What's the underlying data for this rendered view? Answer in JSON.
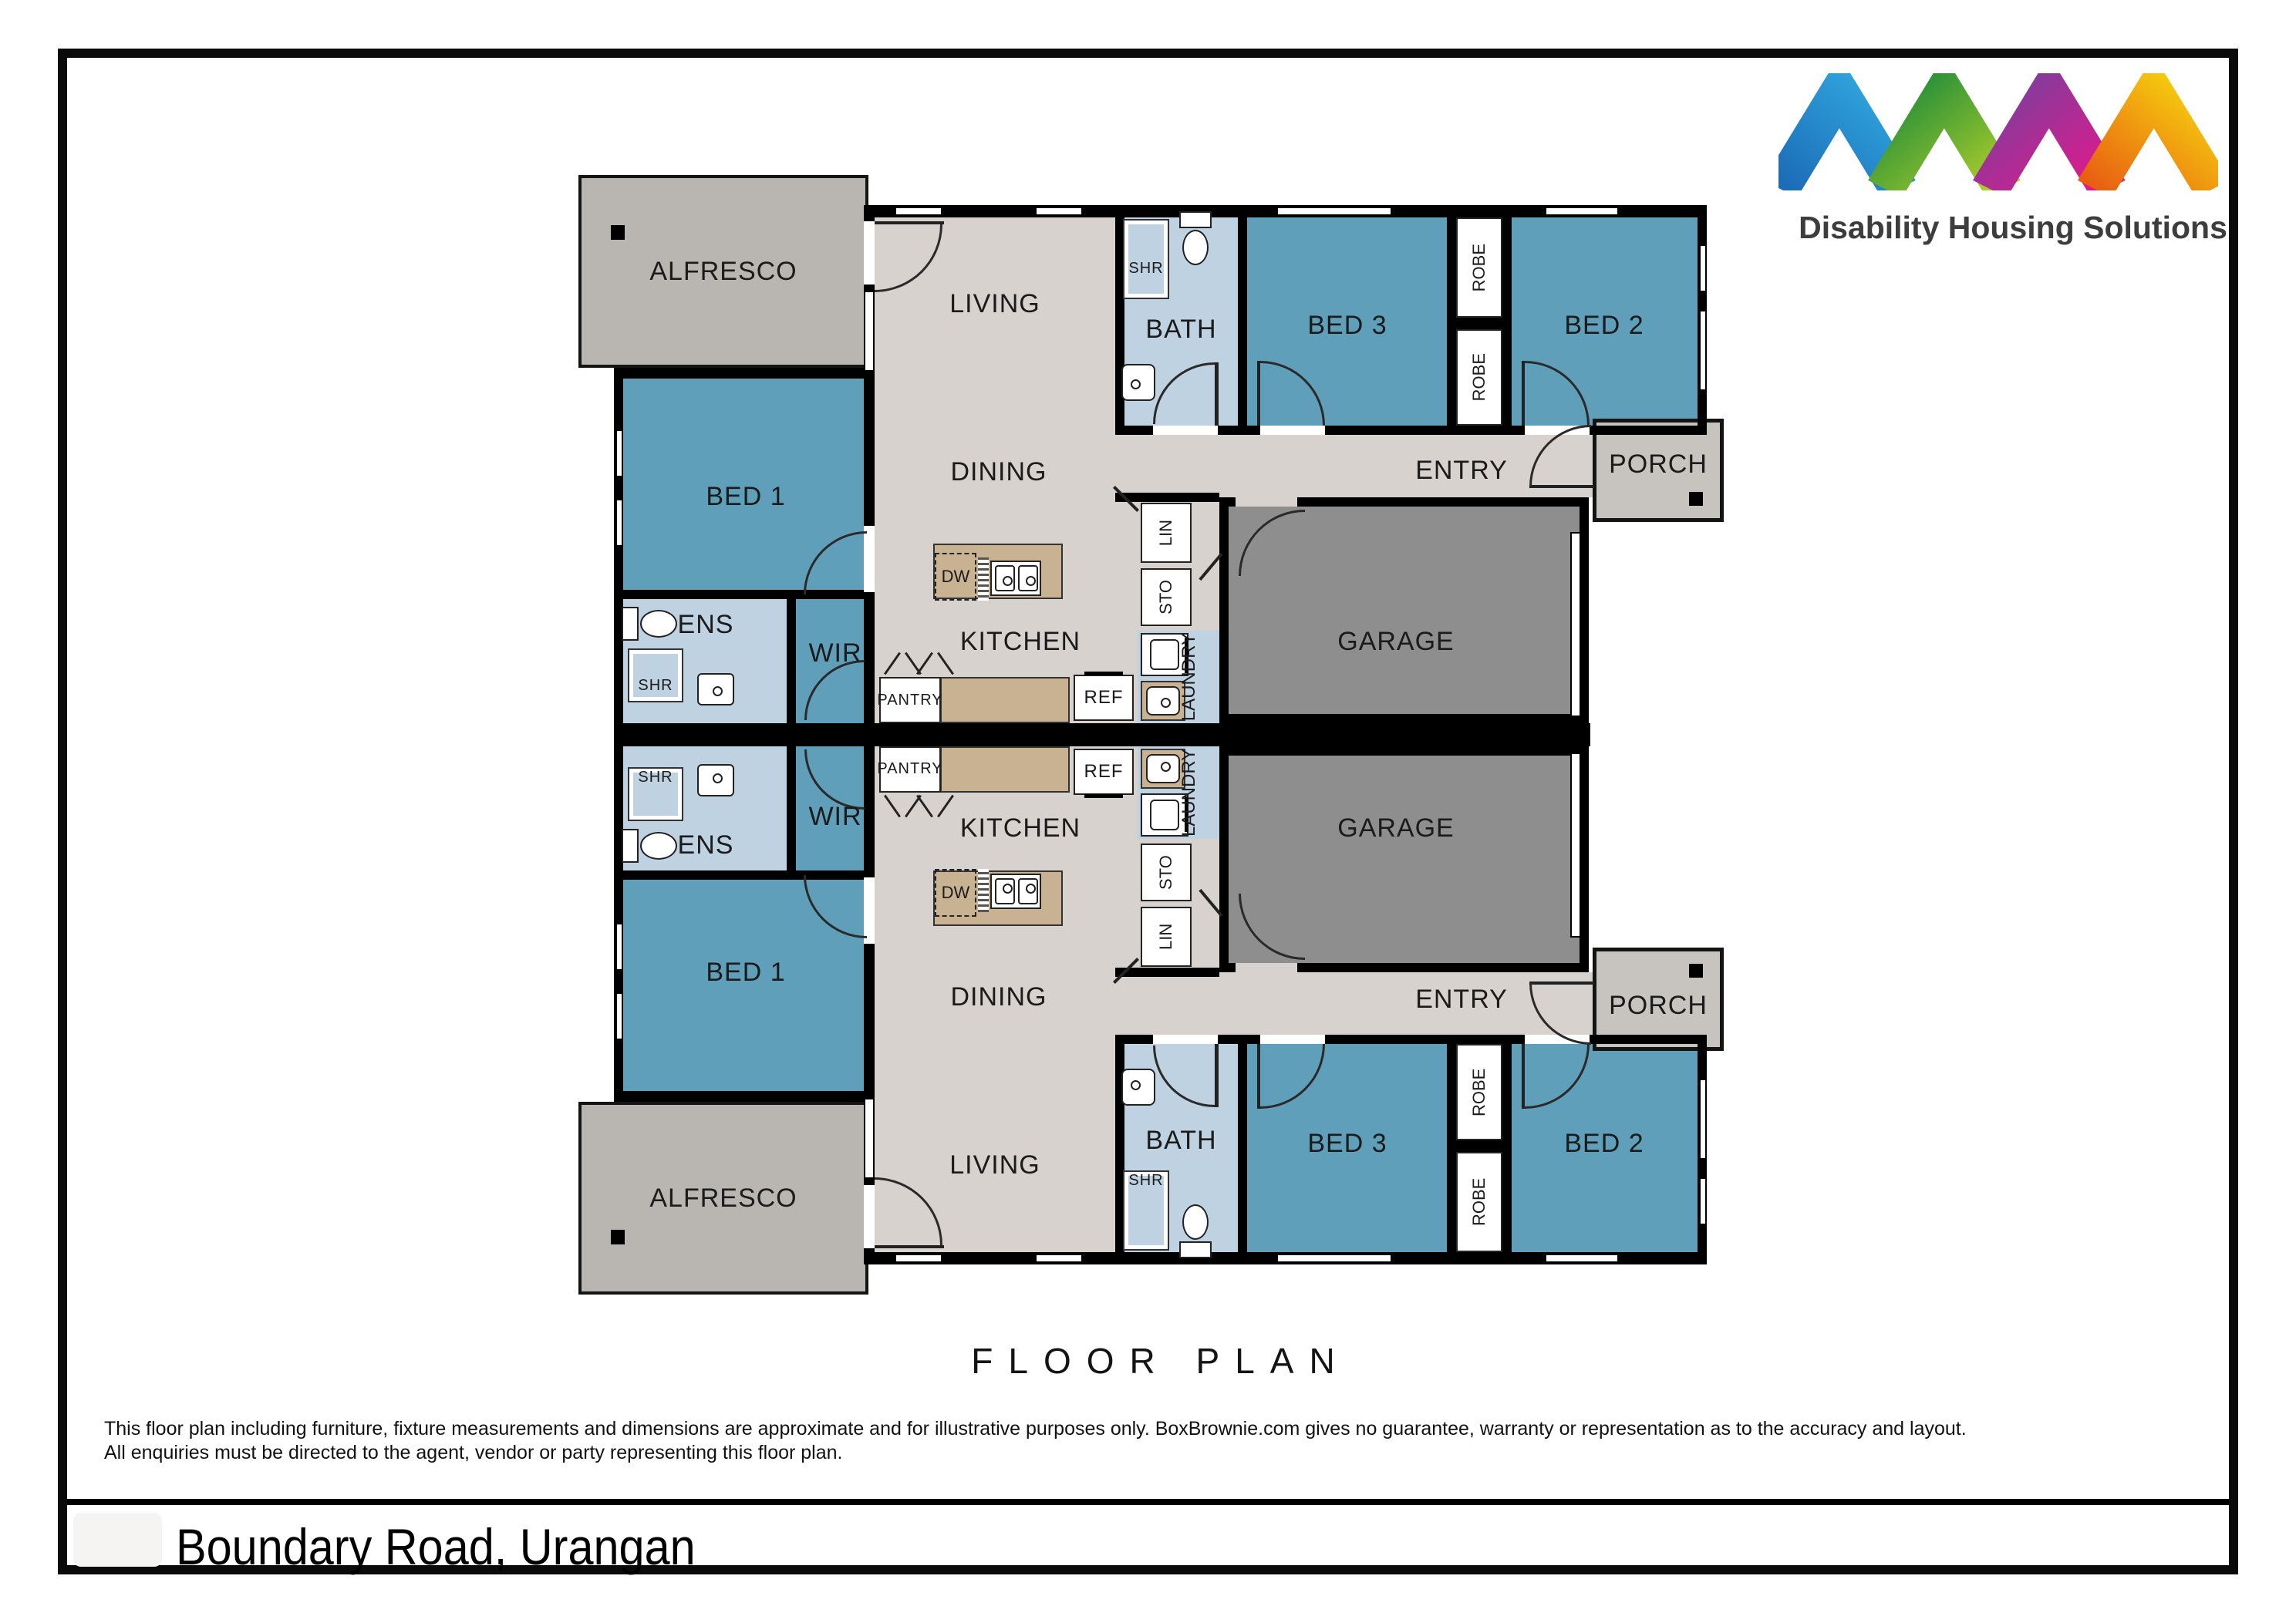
{
  "header": {
    "brand": "Disability Housing Solutions"
  },
  "rooms": {
    "alfresco": "ALFRESCO",
    "living": "LIVING",
    "dining": "DINING",
    "kitchen": "KITCHEN",
    "pantry": "PANTRY",
    "bath": "BATH",
    "bed1": "BED 1",
    "bed2": "BED 2",
    "bed3": "BED 3",
    "robe": "ROBE",
    "entry": "ENTRY",
    "porch": "PORCH",
    "garage": "GARAGE",
    "ens": "ENS",
    "wir": "WIR",
    "shr": "SHR",
    "ref": "REF",
    "dw": "DW",
    "lin": "LIN",
    "sto": "STO",
    "laundry": "LAUNDRY"
  },
  "footer": {
    "plan_title": "FLOOR PLAN",
    "disclaimer_line1": "This floor plan including furniture, fixture measurements and dimensions are approximate and for illustrative purposes only. BoxBrownie.com gives no guarantee, warranty or representation as to the accuracy and layout.",
    "disclaimer_line2": "All enquiries must be directed to the agent, vendor or party representing this floor plan.",
    "address": "Boundary Road, Urangan"
  },
  "colors": {
    "bedroom": "#5f9fba",
    "wet": "#bfd2e2",
    "floor": "#d8d2ce",
    "outdoor": "#b9b5b1",
    "porchc": "#c7c3bf",
    "garage": "#8e8e8e",
    "bench": "#c9b292",
    "wall": "#000000",
    "logo_blue_dark": "#1b6ab5",
    "logo_blue_light": "#31a9e0",
    "logo_green_dark": "#1c8a3a",
    "logo_green_light": "#b5d229",
    "logo_purple": "#7a3f9d",
    "logo_magenta": "#e8178b",
    "logo_orange": "#e85d12",
    "logo_yellow": "#f7d70e"
  }
}
